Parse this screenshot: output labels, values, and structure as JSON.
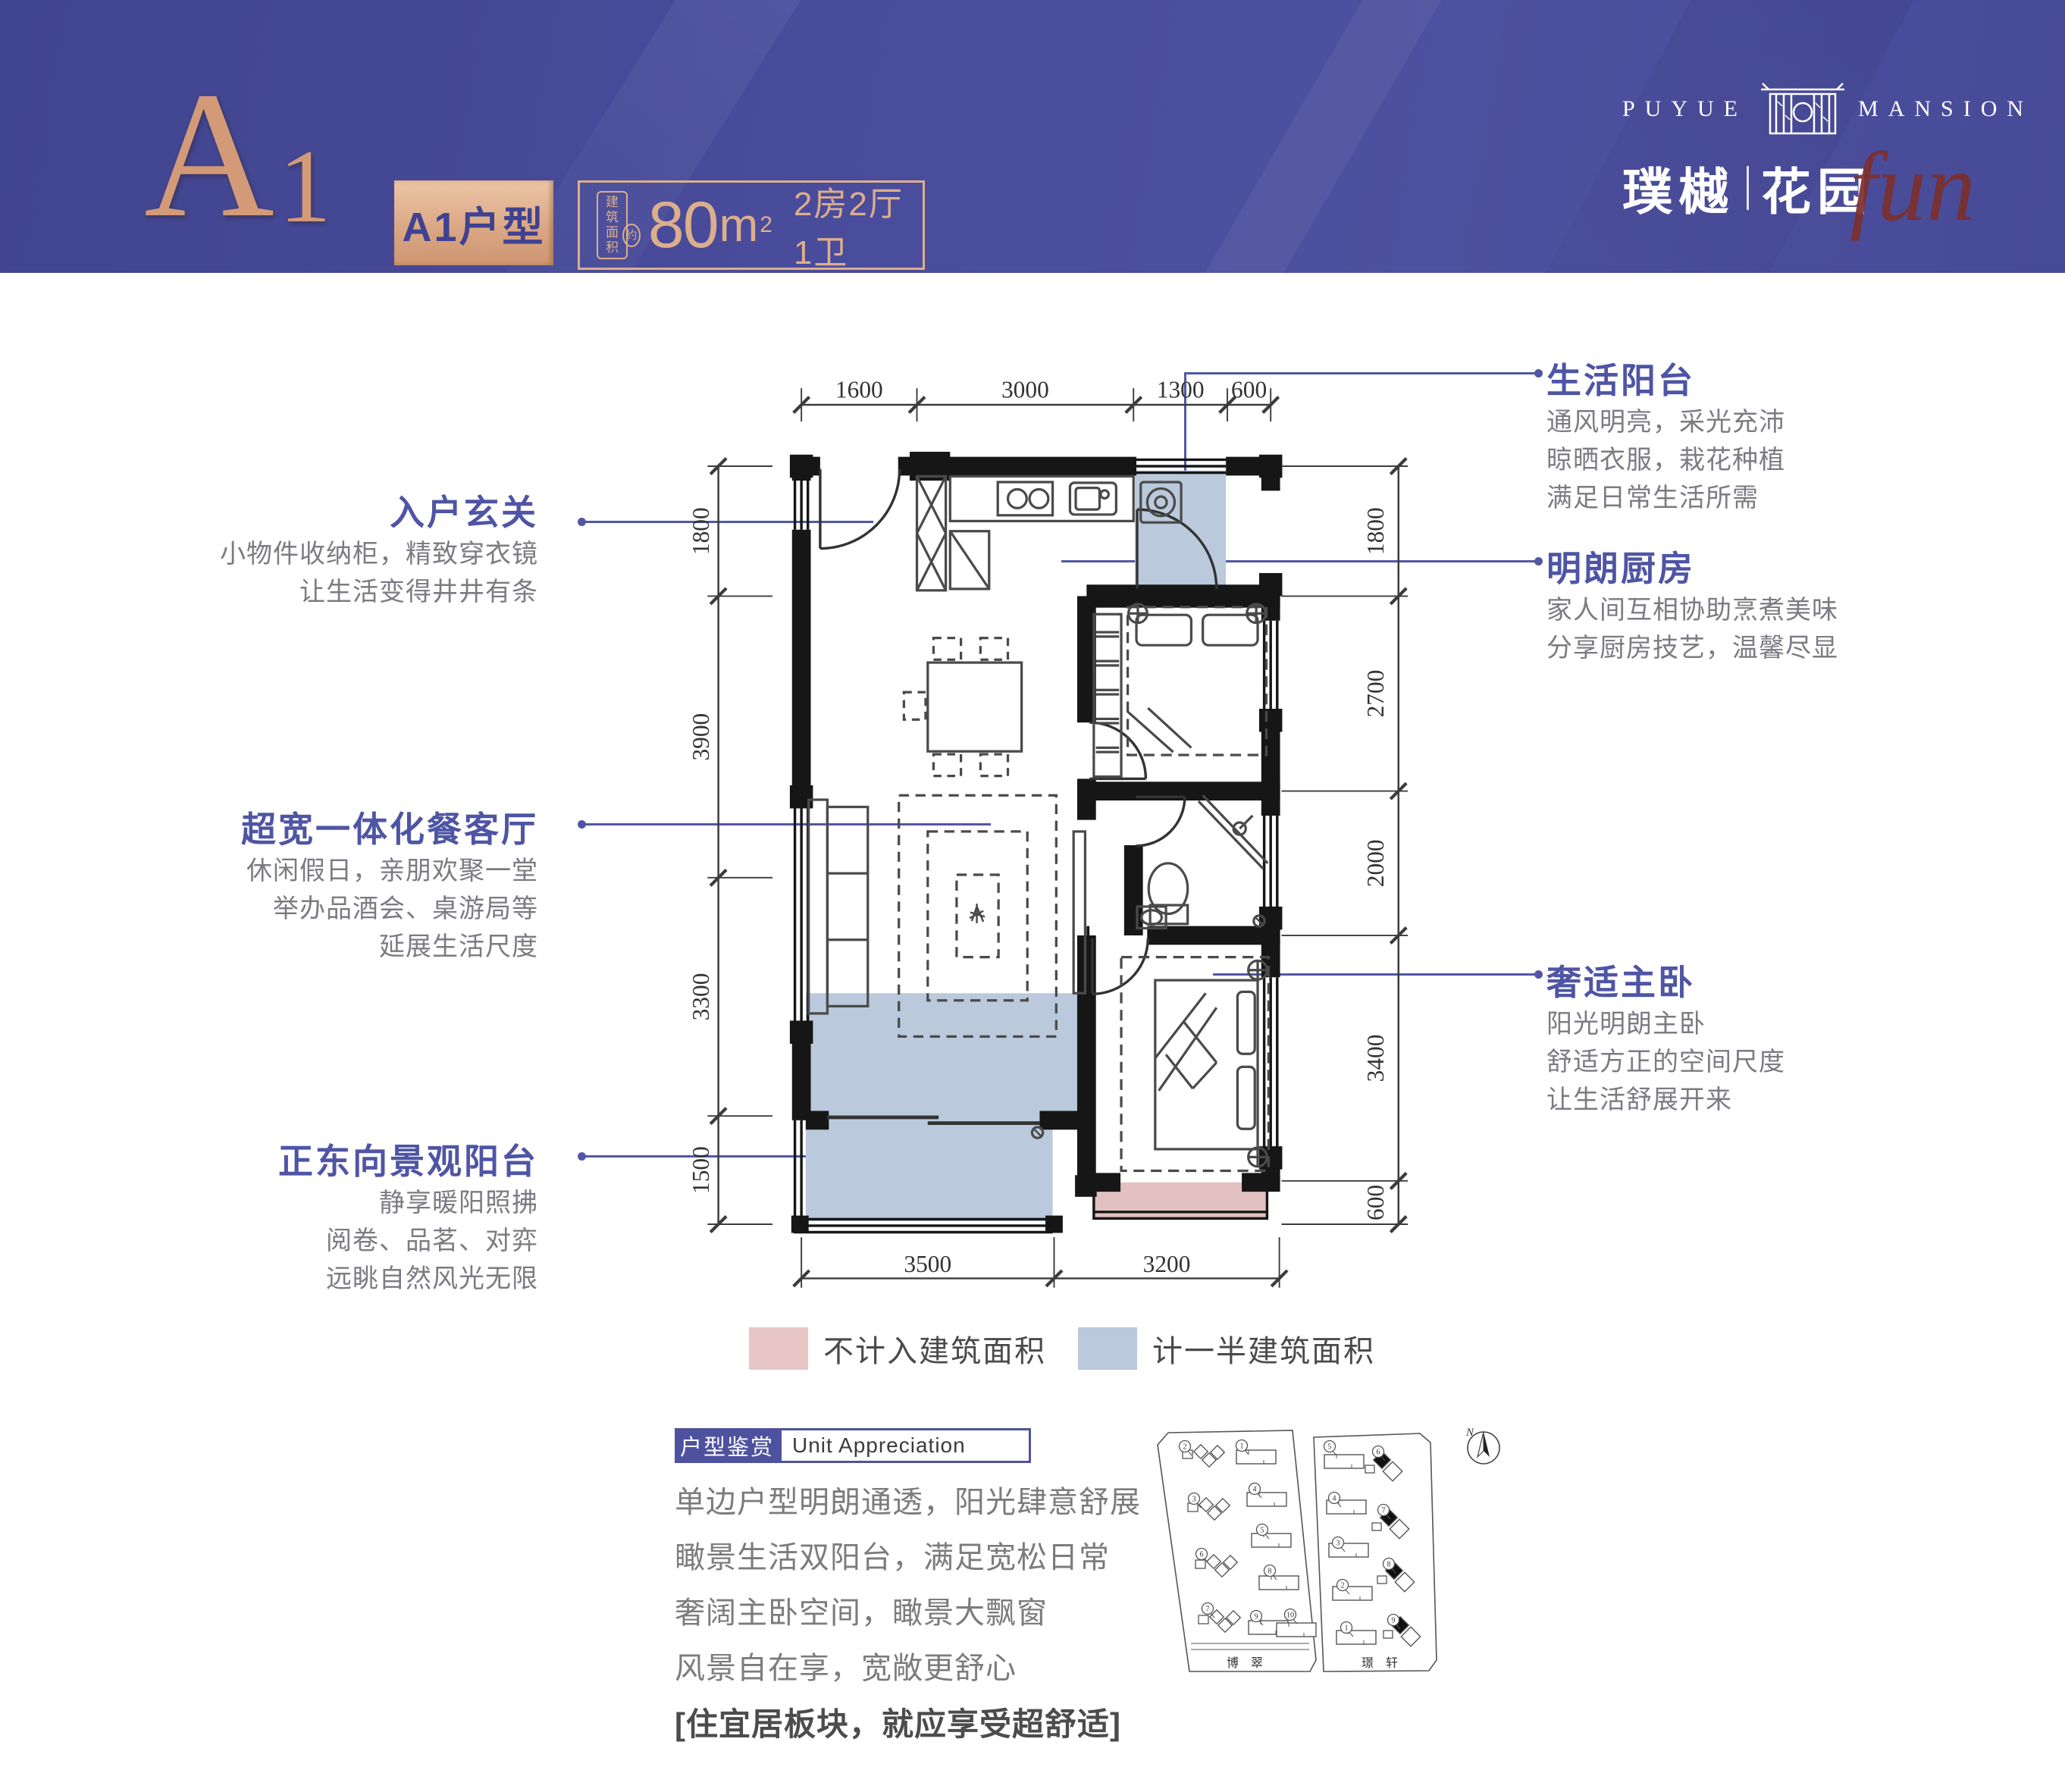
{
  "header": {
    "unit_code_main": "A",
    "unit_code_sub": "1",
    "badge_label": "A1户型",
    "area_prefix_line1": "建筑",
    "area_prefix_line2": "面积",
    "area_prefix_circle": "约",
    "area_value": "80",
    "area_unit": "m",
    "area_sup": "2",
    "rooms": "2房2厅1卫",
    "brand_en_left": "PUYUE",
    "brand_en_right": "MANSION",
    "brand_cn_left": "璞樾",
    "brand_cn_right": "花园",
    "brand_script": "fun",
    "colors": {
      "band": "#494c9b",
      "copper": "#d39a77",
      "badge_text": "#3f4291"
    }
  },
  "callouts": {
    "left": [
      {
        "title": "入户玄关",
        "lines": [
          "小物件收纳柜，精致穿衣镜",
          "让生活变得井井有条"
        ]
      },
      {
        "title": "超宽一体化餐客厅",
        "lines": [
          "休闲假日，亲朋欢聚一堂",
          "举办品酒会、桌游局等",
          "延展生活尺度"
        ]
      },
      {
        "title": "正东向景观阳台",
        "lines": [
          "静享暖阳照拂",
          "阅卷、品茗、对弈",
          "远眺自然风光无限"
        ]
      }
    ],
    "right": [
      {
        "title": "生活阳台",
        "lines": [
          "通风明亮，采光充沛",
          "晾晒衣服，栽花种植",
          "满足日常生活所需"
        ]
      },
      {
        "title": "明朗厨房",
        "lines": [
          "家人间互相协助烹煮美味",
          "分享厨房技艺，温馨尽显"
        ]
      },
      {
        "title": "奢适主卧",
        "lines": [
          "阳光明朗主卧",
          "舒适方正的空间尺度",
          "让生活舒展开来"
        ]
      }
    ]
  },
  "plan": {
    "dims": {
      "top": [
        "1600",
        "3000",
        "1300",
        "600"
      ],
      "left": [
        "1800",
        "3900",
        "3300",
        "1500"
      ],
      "right": [
        "1800",
        "2700",
        "2000",
        "3400",
        "600"
      ],
      "bottom": [
        "3500",
        "3200"
      ]
    },
    "legend": [
      {
        "label": "不计入建筑面积",
        "color": "#e8c6c6"
      },
      {
        "label": "计一半建筑面积",
        "color": "#bac9db"
      }
    ]
  },
  "appreciation": {
    "title_cn": "户型鉴赏",
    "title_en": "Unit  Appreciation",
    "lines": [
      "单边户型明朗通透，阳光肆意舒展",
      "瞰景生活双阳台，满足宽松日常",
      "奢阔主卧空间，瞰景大飘窗",
      "风景自在享，宽敞更舒心"
    ],
    "emphasis": "[住宜居板块，就应享受超舒适]"
  },
  "site_plan": {
    "compass_label": "N",
    "parcels": [
      {
        "name": "博 翠",
        "buildings": [
          {
            "n": "2",
            "kind": "cluster"
          },
          {
            "n": "1",
            "kind": "slab"
          },
          {
            "n": "3",
            "kind": "cluster"
          },
          {
            "n": "4",
            "kind": "slab"
          },
          {
            "n": "5",
            "kind": "slab"
          },
          {
            "n": "6",
            "kind": "cluster"
          },
          {
            "n": "8",
            "kind": "slab"
          },
          {
            "n": "7",
            "kind": "cluster"
          },
          {
            "n": "9",
            "kind": "slab"
          },
          {
            "n": "10",
            "kind": "slab"
          }
        ]
      },
      {
        "name": "璟 轩",
        "buildings": [
          {
            "n": "5",
            "kind": "slab"
          },
          {
            "n": "6",
            "kind": "black"
          },
          {
            "n": "4",
            "kind": "slab"
          },
          {
            "n": "7",
            "kind": "black"
          },
          {
            "n": "3",
            "kind": "slab"
          },
          {
            "n": "8",
            "kind": "black"
          },
          {
            "n": "2",
            "kind": "slab"
          },
          {
            "n": "9",
            "kind": "black"
          },
          {
            "n": "1",
            "kind": "slab"
          }
        ]
      }
    ]
  }
}
